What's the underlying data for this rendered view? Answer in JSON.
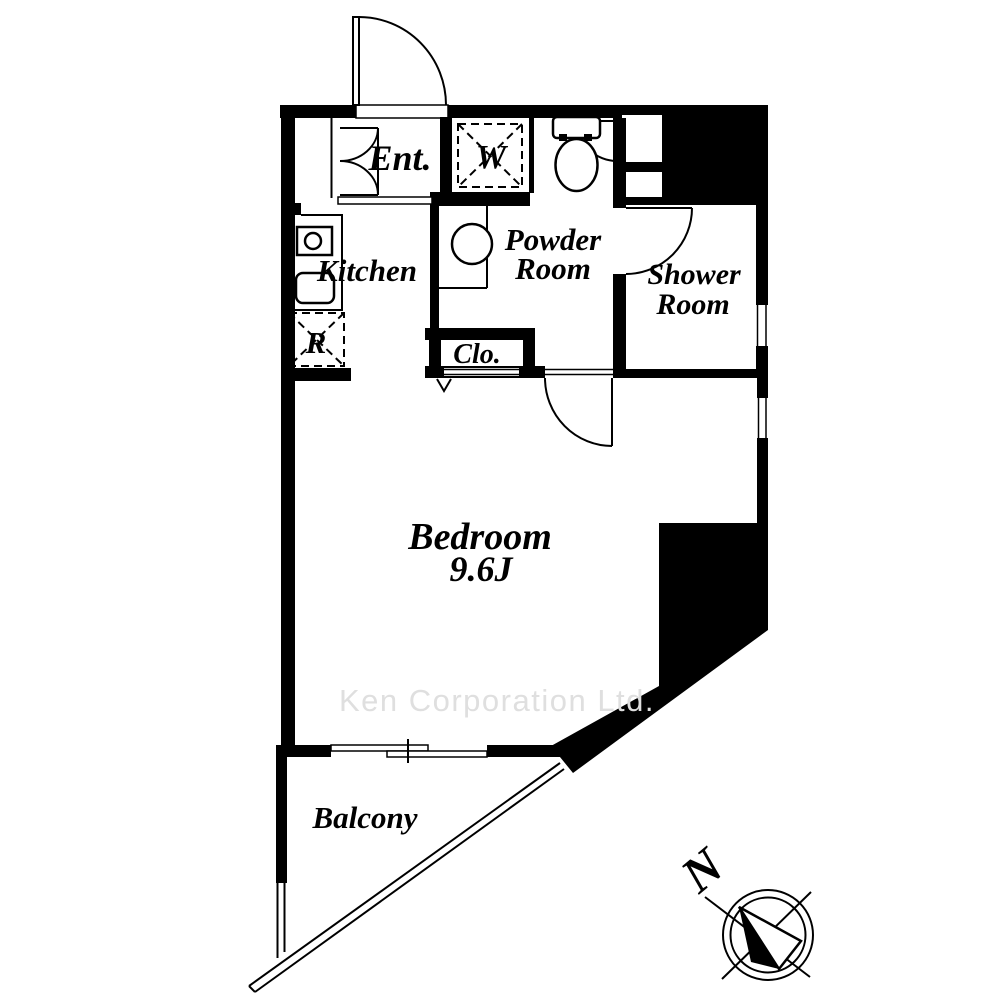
{
  "colors": {
    "wall": "#000000",
    "background": "#ffffff",
    "watermark": "#dfdfdf"
  },
  "watermark": "Ken Corporation Ltd.",
  "compass": {
    "north_label": "N"
  },
  "rooms": {
    "entrance": {
      "label": "Ent."
    },
    "washer_box": {
      "label": "W"
    },
    "kitchen": {
      "label": "Kitchen"
    },
    "fridge_box": {
      "label": "R"
    },
    "powder_room": {
      "line1": "Powder",
      "line2": "Room"
    },
    "shower_room": {
      "line1": "Shower",
      "line2": "Room"
    },
    "closet": {
      "label": "Clo."
    },
    "bedroom": {
      "name": "Bedroom",
      "size": "9.6J"
    },
    "balcony": {
      "label": "Balcony"
    }
  },
  "fixtures": [
    "toilet-icon",
    "washbasin-icon",
    "stove-icon",
    "sink-icon",
    "washing-machine-box",
    "refrigerator-box",
    "entrance-shoe-closet",
    "balcony-railing",
    "compass-rose"
  ]
}
